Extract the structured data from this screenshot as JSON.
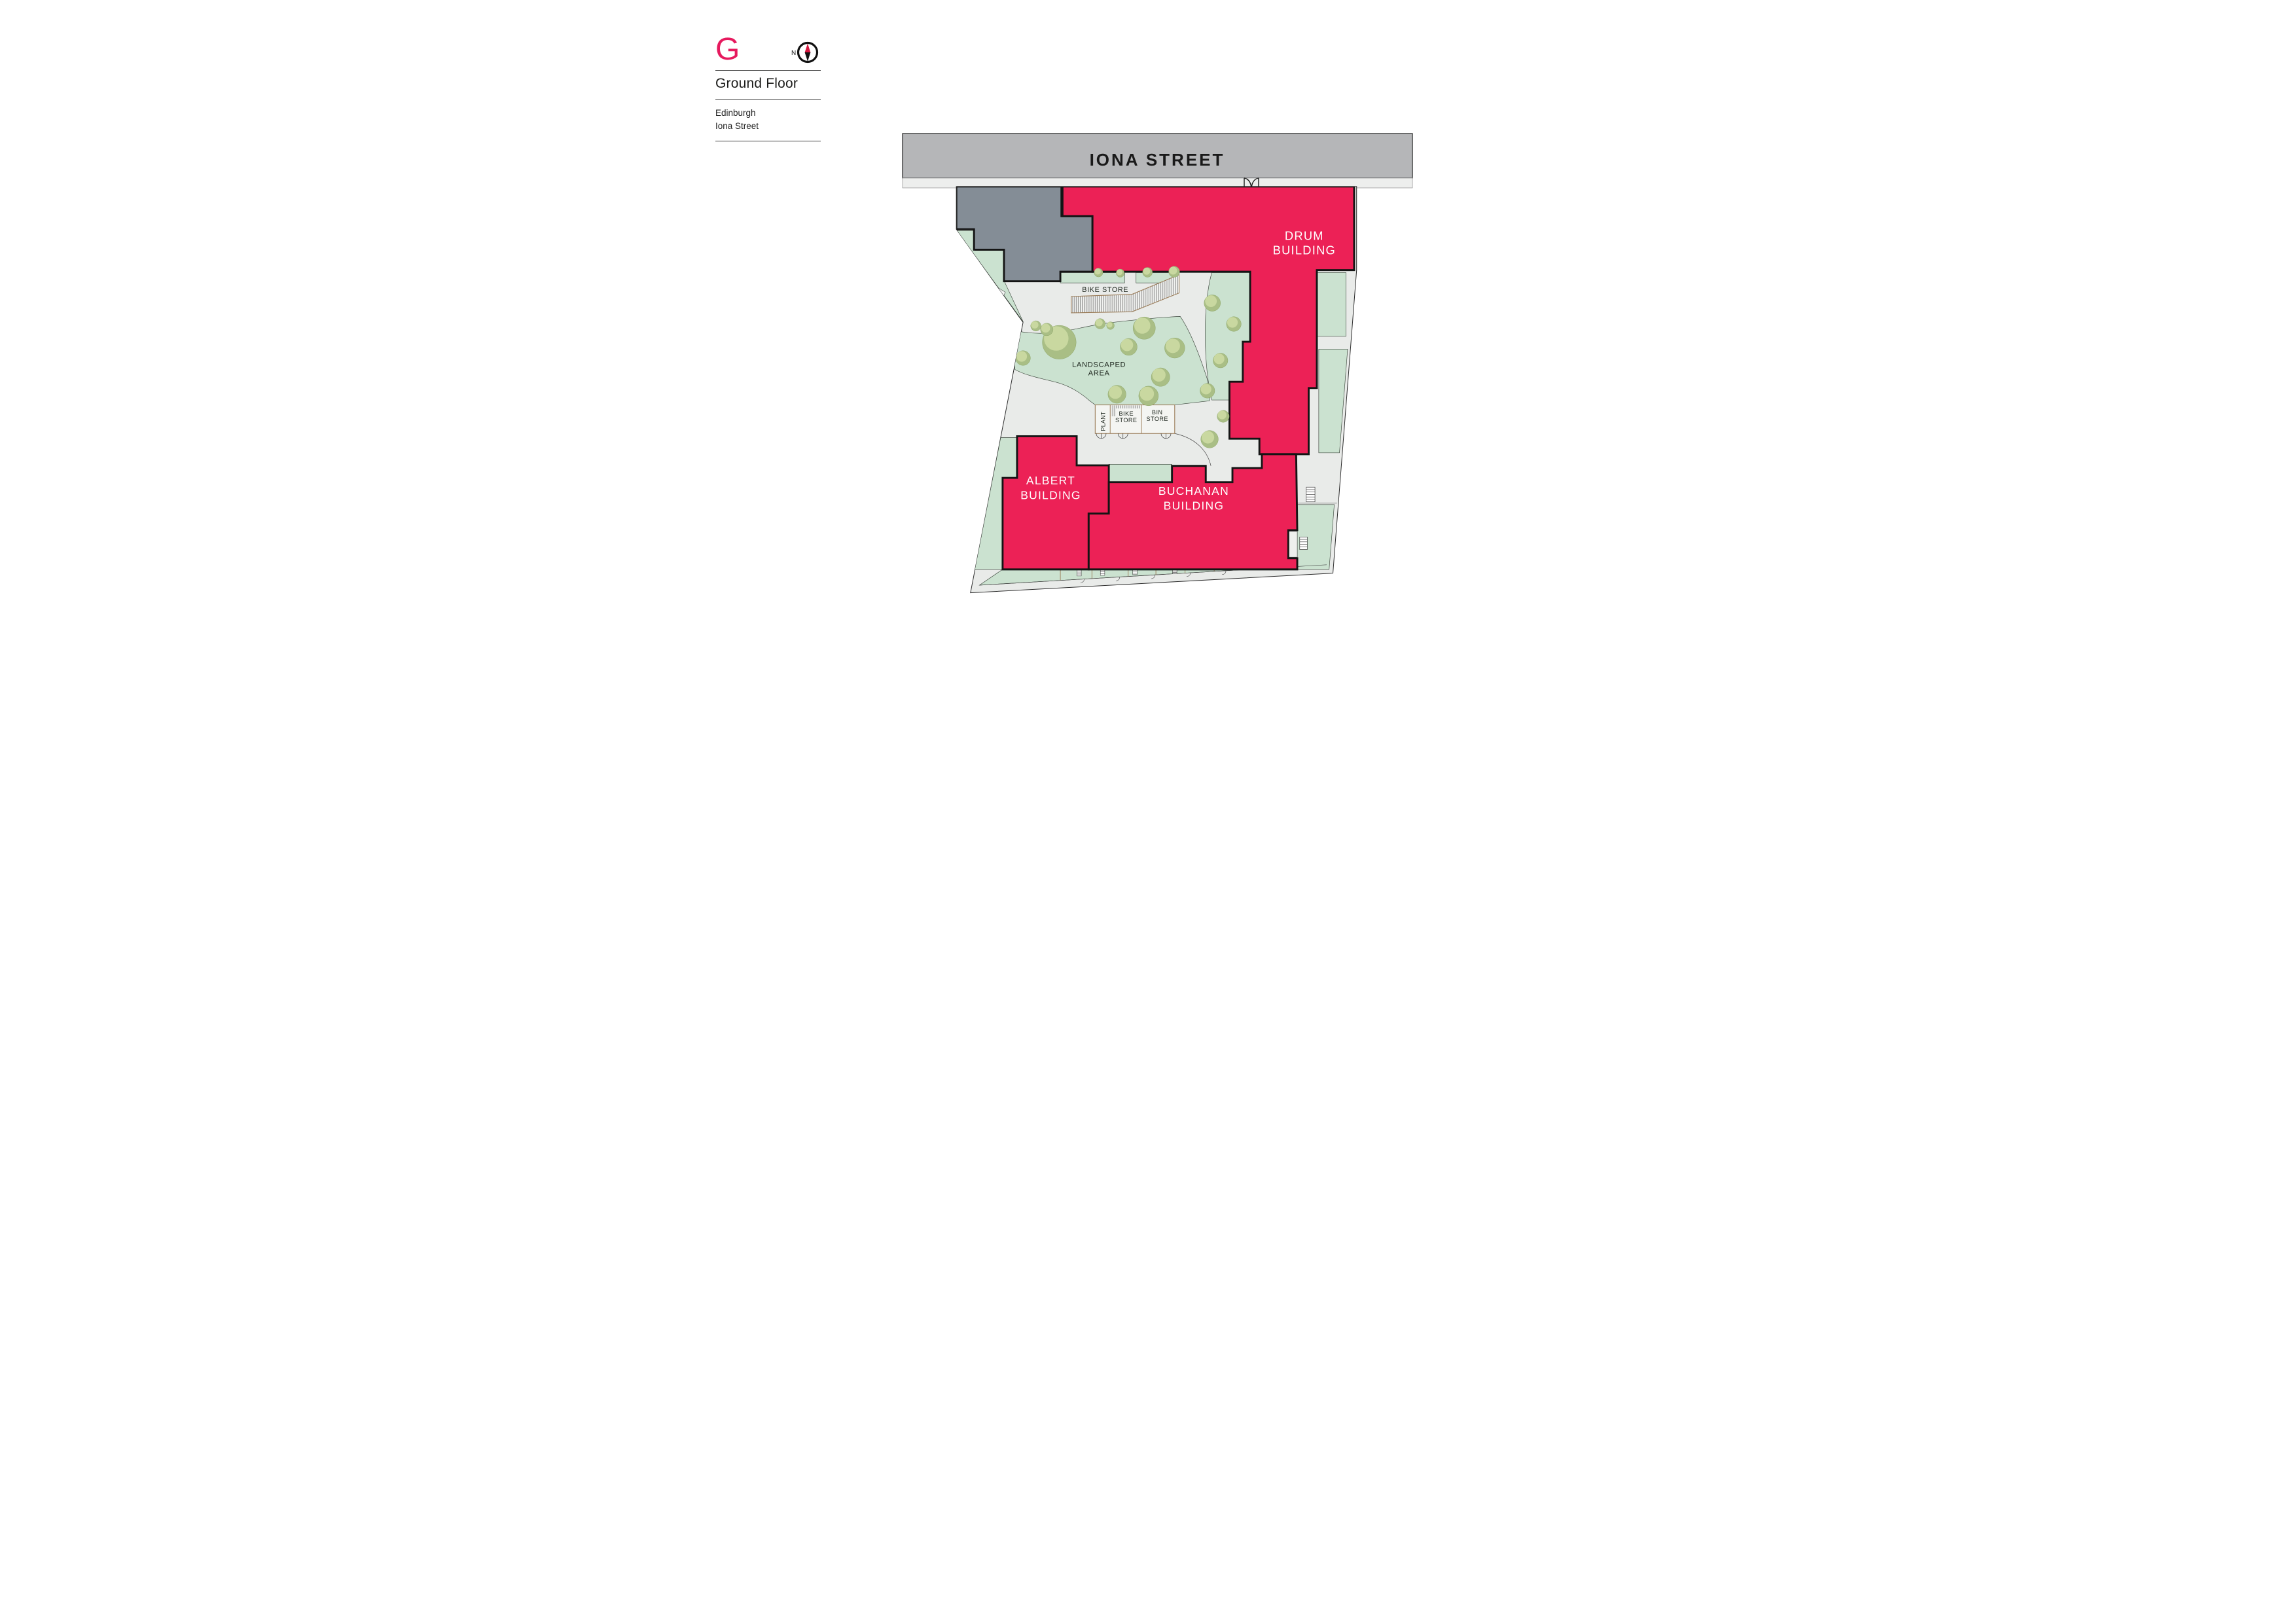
{
  "header": {
    "logo_letter": "G",
    "compass_label": "N",
    "floor_title": "Ground Floor",
    "location_line1": "Edinburgh",
    "location_line2": "Iona Street"
  },
  "plan": {
    "street_label": "IONA STREET",
    "buildings": [
      {
        "id": "drum",
        "label_line1": "DRUM",
        "label_line2": "BUILDING"
      },
      {
        "id": "albert",
        "label_line1": "ALBERT",
        "label_line2": "BUILDING"
      },
      {
        "id": "buchanan",
        "label_line1": "BUCHANAN",
        "label_line2": "BUILDING"
      }
    ],
    "areas": {
      "bike_store_main": "BIKE STORE",
      "landscaped_line1": "LANDSCAPED",
      "landscaped_line2": "AREA",
      "plant": "PLANT",
      "bike_store_small_line1": "BIKE",
      "bike_store_small_line2": "STORE",
      "bin_store_line1": "BIN",
      "bin_store_line2": "STORE"
    },
    "colors": {
      "building_pink": "#EC2156",
      "building_gray": "#848D96",
      "green": "#CBE2D0",
      "road_gray": "#B5B6B8",
      "path_gray": "#E9EBE9",
      "accent_pink": "#E6195E",
      "store_brown": "#9A7B57"
    }
  }
}
